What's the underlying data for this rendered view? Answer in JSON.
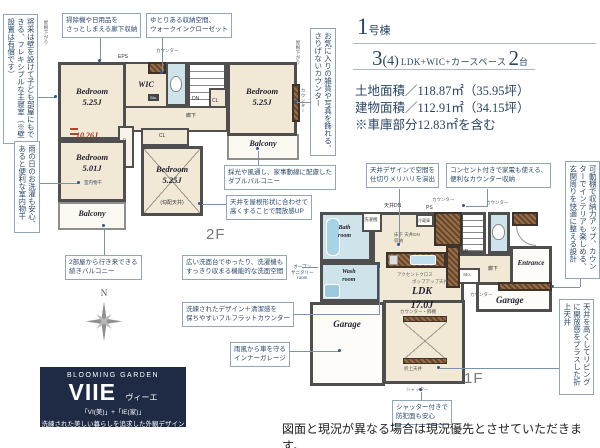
{
  "header": {
    "building_number": "1",
    "building_unit": "号棟",
    "plan_main": "3",
    "plan_paren": "(4)",
    "plan_desc": "LDK+WIC+カースペース",
    "plan_cars": "2",
    "plan_cars_unit": "台",
    "land_area": "土地面積／118.87㎡（35.95坪）",
    "building_area": "建物面積／112.91㎡（34.15坪）",
    "garage_note": "※車庫部分12.83㎡を含む"
  },
  "callouts": [
    {
      "text": "掃除機や日用品を\nさっとしまえる廊下収納"
    },
    {
      "text": "ゆとりある収納空間、\nウォークインクローゼット"
    },
    {
      "text": "採光や風通し、家事動線に配慮した\nダブルバルコニー"
    },
    {
      "text": "天井を屋根形状に合わせて\n高くすることで開放感UP"
    },
    {
      "text": "2部屋から行き来できる\n続きバルコニー"
    },
    {
      "text": "広い洗面台でゆったり、洗濯機も\nすっきり収まる機能的な洗面空間"
    },
    {
      "text": "天井デザインで空間を\n仕切りメリハリを演出"
    },
    {
      "text": "コンセント付きで家電も使える、\n便利なカウンター収納"
    },
    {
      "text": "洗練されたデザイン＋清潔感を\n保ちやすいフルフラットカウンター"
    },
    {
      "text": "雨風から車を守る\nインナーガレージ"
    },
    {
      "text": "シャッター付きで\n防犯面も安心"
    }
  ],
  "vertical_callouts": [
    {
      "text": "将来は壁を設けて子ども部屋にもできる、フレキシブルな主寝室（※壁設置は有償です）"
    },
    {
      "text": "雨の日のお洗濯も安心、あると便利な室内物干"
    },
    {
      "text": "お気に入りの雑貨や写真を飾れる、さりげないカウンター"
    },
    {
      "text": "可動棚で収納力アップ、カウンターでインテリアも楽しめる、玄関周りを快適に整える設計"
    },
    {
      "text": "天井を高くしてリビングに開放感をプラスした折上天井"
    }
  ],
  "plan2f": {
    "floor_label": "2F",
    "bedroom_a": "Bedroom\n5.25J",
    "bedroom_b": "Bedroom\n5.01J",
    "bedroom_c": "Bedroom\n5.25J",
    "bedroom_d": "Bedroom\n5.25J",
    "bedroom_d_note": "(勾配天井)",
    "combined": "10.26J",
    "wic": "WIC",
    "eps": "EPS",
    "dn": "DN",
    "sto": "Sto.",
    "hall": "廊下",
    "cl_left": "CL",
    "cl_mid": "CL",
    "cl_right": "CL",
    "counter_top": "カウンター",
    "counter_right": "カウンター",
    "balcony_left": "Balcony",
    "balcony_right": "Balcony",
    "indoor_drying": "室内物干",
    "roof_slope_left": "屋根下がり",
    "roof_slope_right": "屋根下がり"
  },
  "plan1f": {
    "floor_label": "1F",
    "ldk": "LDK\n17.0J",
    "bath": "Bath\nroom",
    "wash": "Wash\nroom",
    "entrance": "Entrance",
    "garage_left": "Garage",
    "garage_right": "Garage",
    "hall": "廊下",
    "up": "UP",
    "sto": "Sto.",
    "ps": "PS",
    "ceiling_dn": "天井DN",
    "counter_top": "カウンター",
    "counter_toilet": "カウンター",
    "counter_garage": "カウンター",
    "washer": "洗濯機",
    "fridge": "冷蔵庫",
    "floor_storage": "床下 天井DN\n収納",
    "accent": "アクセントクロス",
    "popup": "ポップアップ天井",
    "counter_shelf": "カウンター・飾棚",
    "folded": "折上天井",
    "shutter": "シャッター",
    "open_sanitary": "オープン\nサニタリー\nroom"
  },
  "logo": {
    "brand": "BLOOMING GARDEN",
    "name": "VIIE",
    "name_kana": "ヴィーエ",
    "name_meaning": "「VI(美)」+「IE(家)」",
    "tagline": "洗練された美しい暮らしを追求した外観デザイン"
  },
  "compass": {
    "north": "N"
  },
  "disclaimer": "図面と現況が異なる場合は現況優先とさせていただきます。",
  "colors": {
    "navy": "#2c4a6e",
    "callout_border": "#8fa6bd",
    "room_cream": "#f1e9d5",
    "wet_blue": "#cfe4ea",
    "wall": "#4f4f4f",
    "counter_brown": "#6a4526",
    "accent_red": "#c33a2e",
    "logo_navy": "#1f2a44"
  }
}
